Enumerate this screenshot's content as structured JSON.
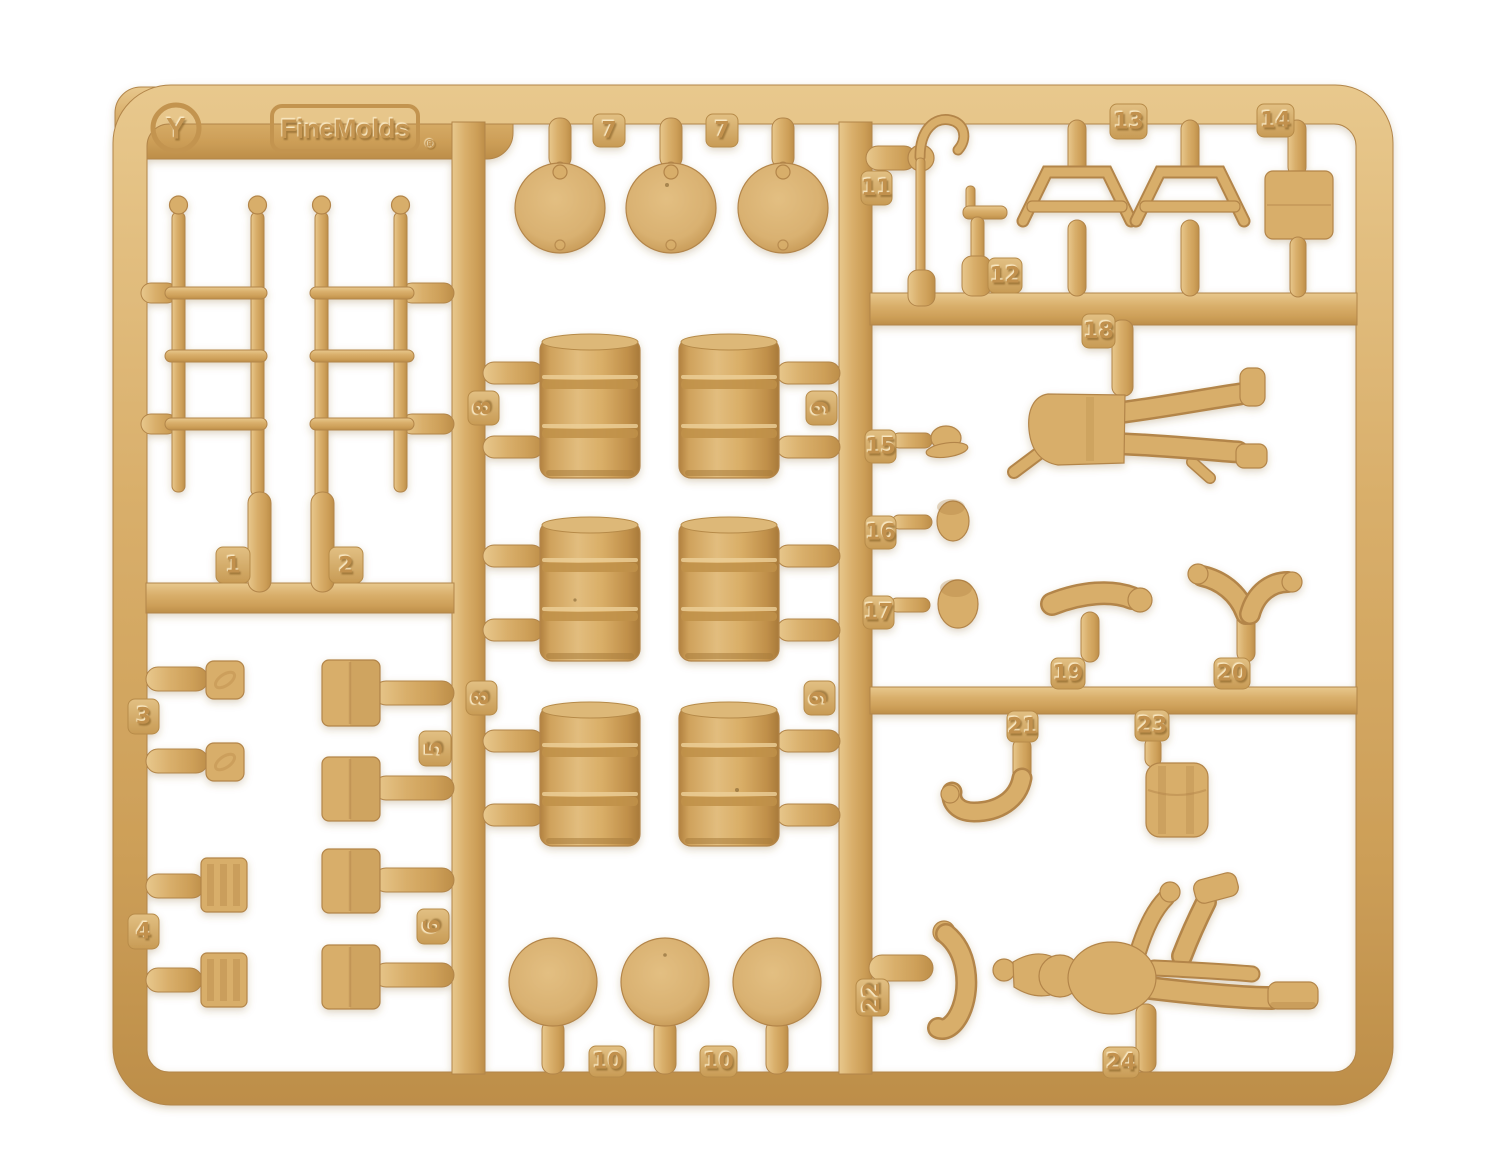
{
  "photo": {
    "subject": "tan injection-molded model kit parts sprue on white background",
    "background_color": "#ffffff",
    "plastic_color": "#d8ae6a",
    "plastic_shadow_color": "#b3854a",
    "plastic_highlight_color": "#ecd2a0"
  },
  "sprue": {
    "gate_letter": "Y",
    "brand": "FineMolds",
    "registered_mark": "®"
  },
  "tags": {
    "t1": "1",
    "t2": "2",
    "t3": "3",
    "t4": "4",
    "t5": "5",
    "t6": "6",
    "t7a": "7",
    "t7b": "7",
    "t8a": "8",
    "t8b": "8",
    "t9a": "9",
    "t9b": "9",
    "t10a": "10",
    "t10b": "10",
    "t11": "11",
    "t12": "12",
    "t13": "13",
    "t14": "14",
    "t15": "15",
    "t16": "16",
    "t17": "17",
    "t18": "18",
    "t19": "19",
    "t20": "20",
    "t21": "21",
    "t22": "22",
    "t23": "23",
    "t24": "24"
  }
}
